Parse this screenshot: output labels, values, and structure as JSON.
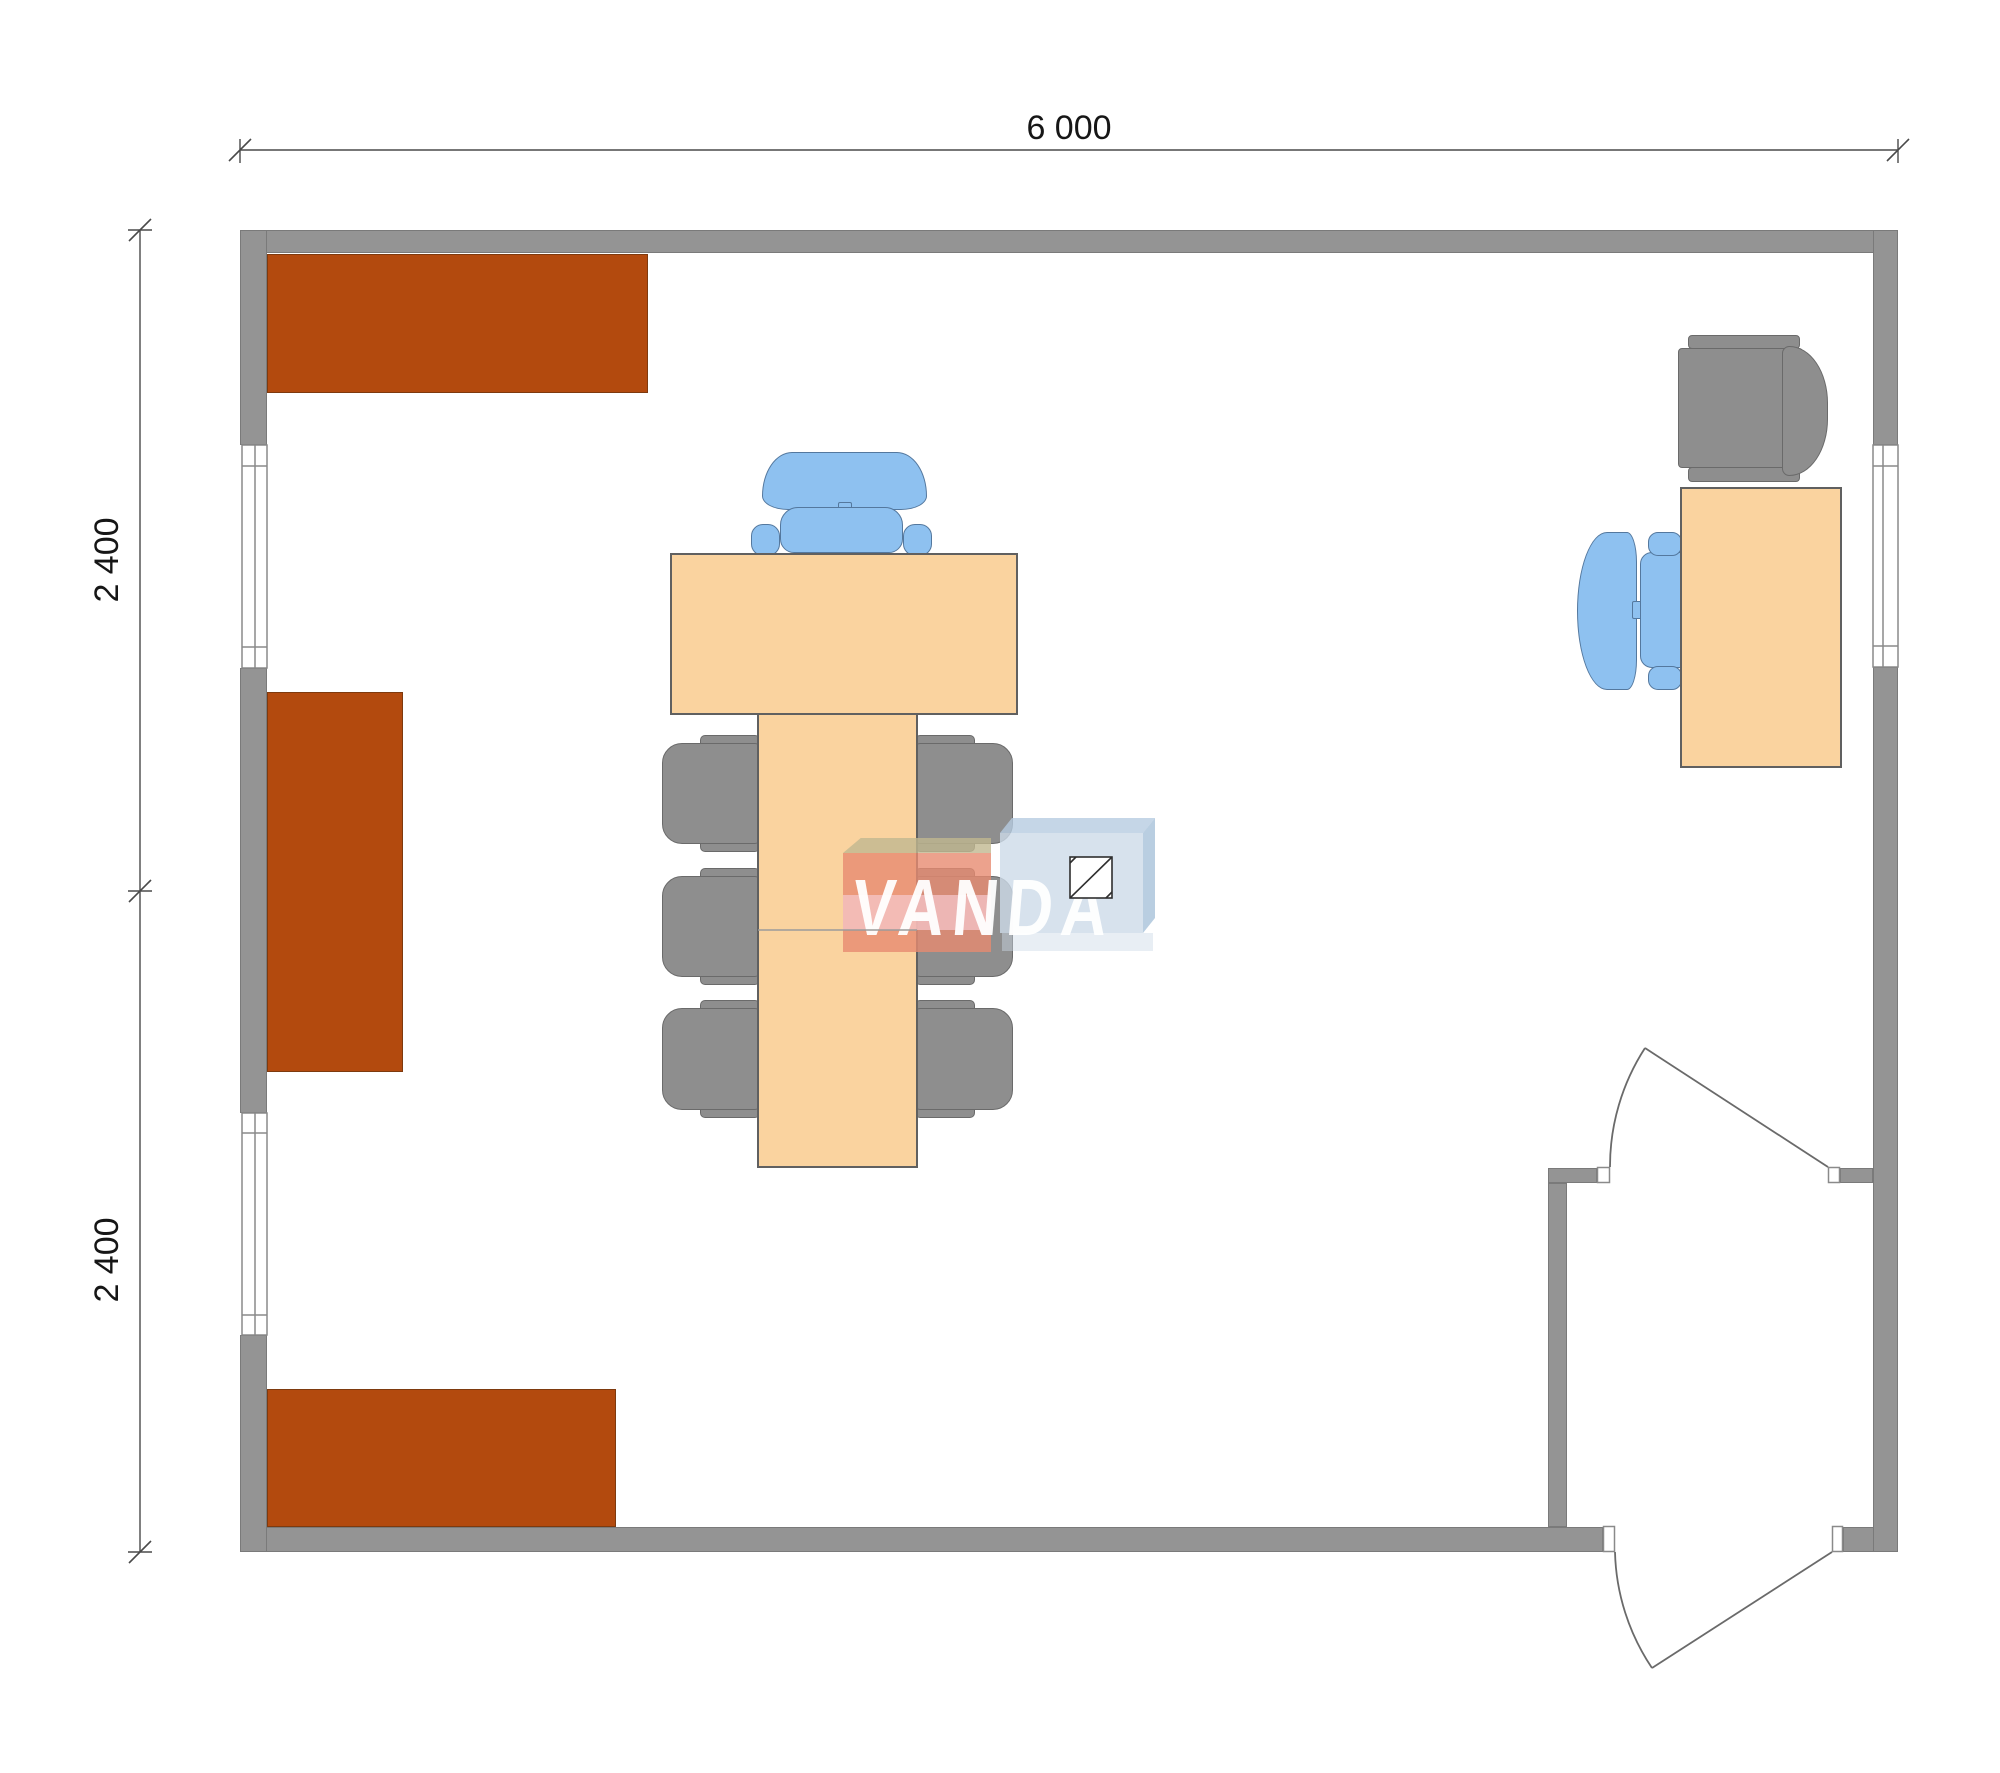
{
  "page": {
    "type": "architectural-floor-plan",
    "background": "#ffffff"
  },
  "dimensions": {
    "width_total": {
      "label": "6 000"
    },
    "height_upper": {
      "label": "2 400"
    },
    "height_lower": {
      "label": "2 400"
    }
  },
  "watermark": {
    "brand": "VANDA"
  },
  "colors": {
    "wall_gray": "#949494",
    "cabinet_brown": "#b34a0e",
    "wood_tan": "#fad39f",
    "chair_gray": "#8e8e8e",
    "chair_blue": "#8ec1f0",
    "dimension_line": "#4a4a4a",
    "watermark_salmon": "#e78b71",
    "watermark_pink_stripe": "#f6c9cf",
    "watermark_olive": "#c0b890",
    "watermark_blue_front": "#cddbe9",
    "watermark_blue_top": "#b6cce1",
    "watermark_blue_side": "#a8c2da"
  }
}
